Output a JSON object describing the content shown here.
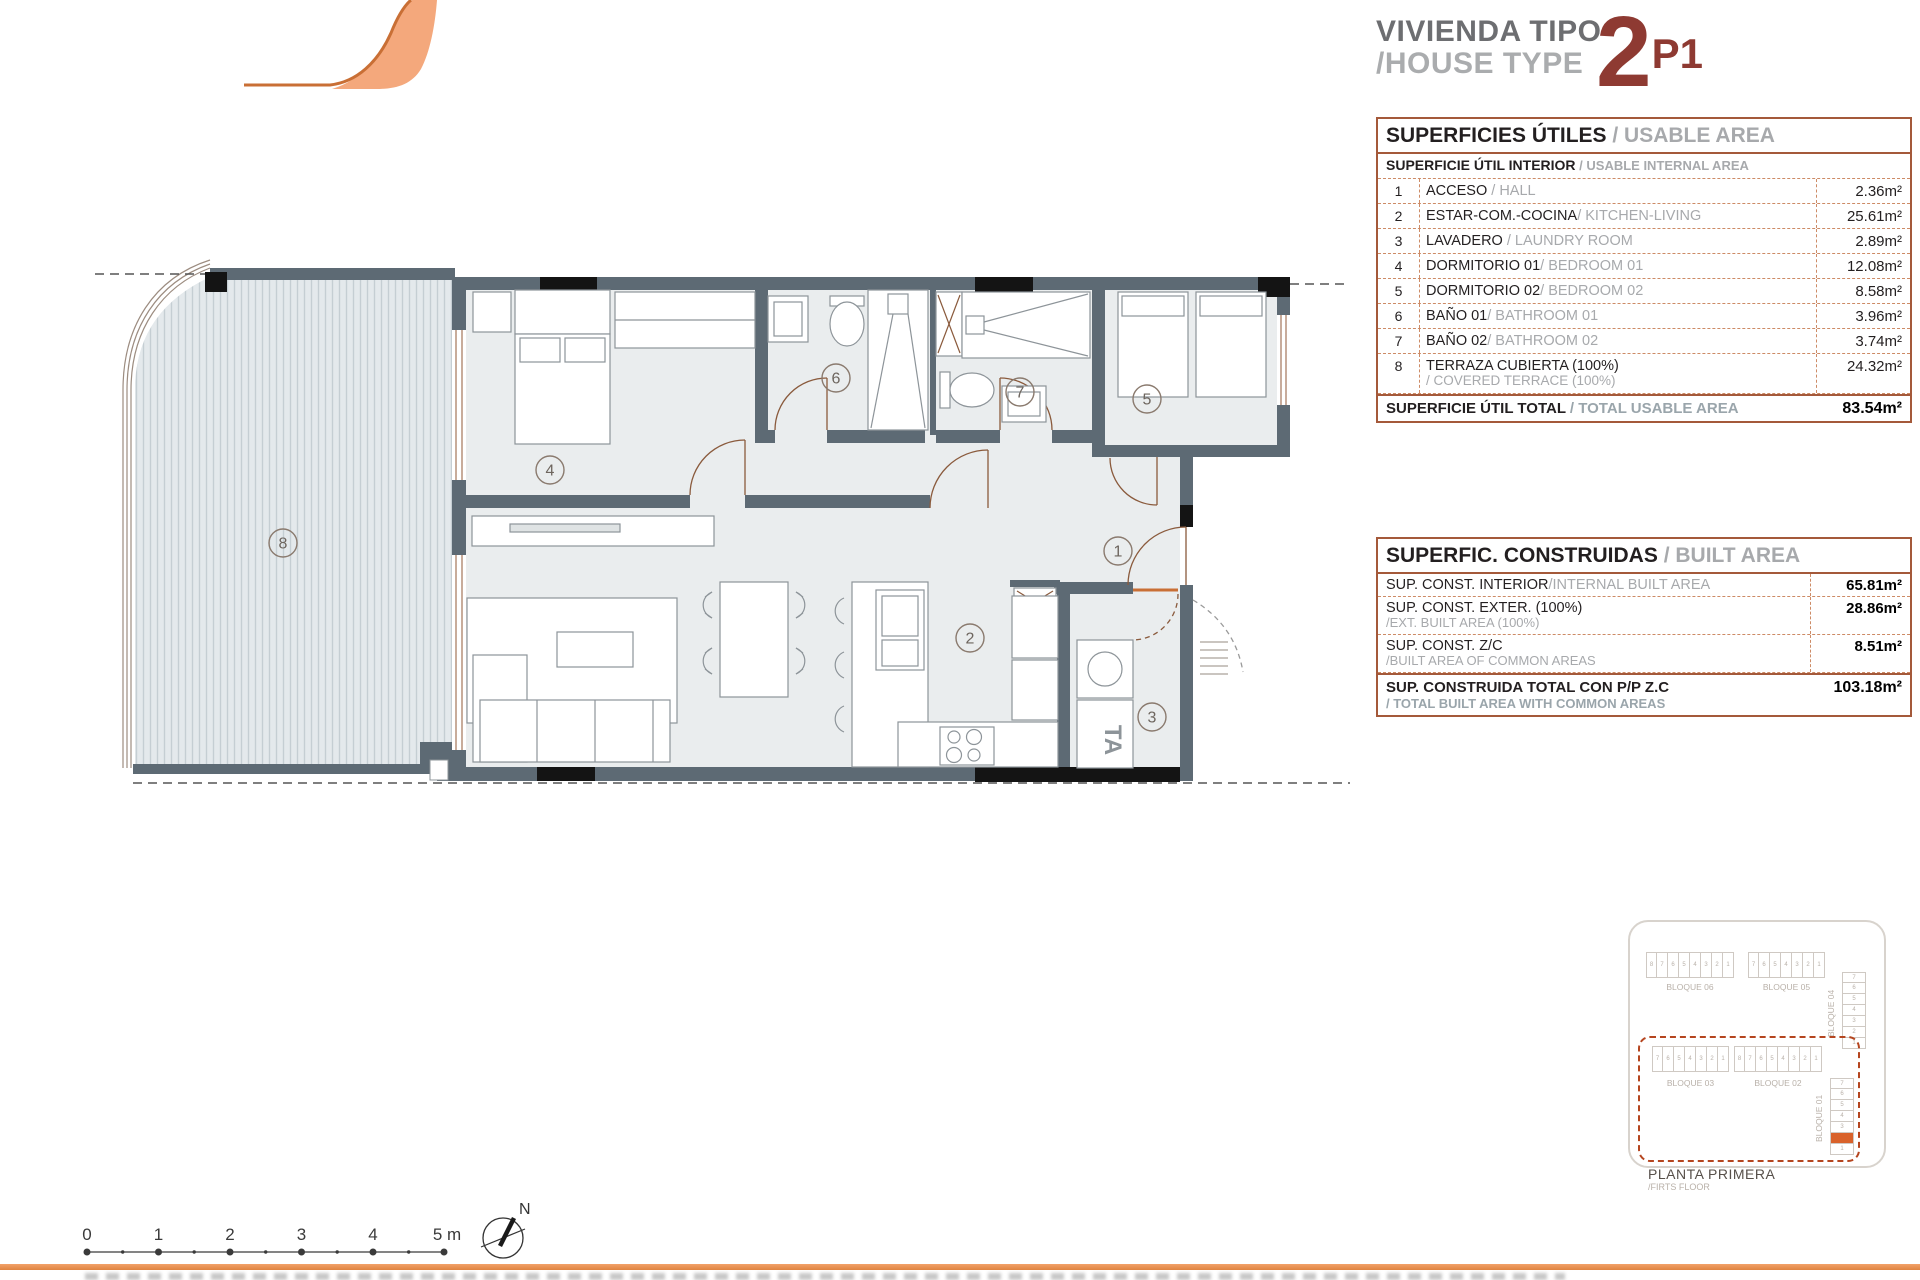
{
  "header": {
    "title_es": "VIVIENDA TIPO",
    "title_en": "/HOUSE TYPE",
    "type_number": "2",
    "type_variant": "P1"
  },
  "usable_area_table": {
    "title_es": "SUPERFICIES ÚTILES",
    "title_en": " / USABLE AREA",
    "subtitle_es": "SUPERFICIE ÚTIL INTERIOR",
    "subtitle_en": " / USABLE INTERNAL AREA",
    "rows": [
      {
        "num": "1",
        "name_es": "ACCESO",
        "name_en": " / HALL",
        "value": "2.36m²"
      },
      {
        "num": "2",
        "name_es": "ESTAR-COM.-COCINA",
        "name_en": "/ KITCHEN-LIVING",
        "value": "25.61m²"
      },
      {
        "num": "3",
        "name_es": "LAVADERO",
        "name_en": " / LAUNDRY ROOM",
        "value": "2.89m²"
      },
      {
        "num": "4",
        "name_es": "DORMITORIO 01",
        "name_en": "/ BEDROOM 01",
        "value": "12.08m²"
      },
      {
        "num": "5",
        "name_es": "DORMITORIO 02",
        "name_en": "/ BEDROOM 02",
        "value": "8.58m²"
      },
      {
        "num": "6",
        "name_es": "BAÑO 01",
        "name_en": "/ BATHROOM 01",
        "value": "3.96m²"
      },
      {
        "num": "7",
        "name_es": "BAÑO 02",
        "name_en": "/ BATHROOM 02",
        "value": "3.74m²"
      },
      {
        "num": "8",
        "name_es": "TERRAZA CUBIERTA (100%)",
        "name_en": "/ COVERED TERRACE (100%)",
        "value": "24.32m²"
      }
    ],
    "total_label_es": "SUPERFICIE ÚTIL TOTAL",
    "total_label_en": " / TOTAL USABLE AREA",
    "total_value": "83.54m²"
  },
  "built_area_table": {
    "title_es": "SUPERFIC. CONSTRUIDAS",
    "title_en": " / BUILT AREA",
    "rows": [
      {
        "label_es": "SUP. CONST. INTERIOR",
        "label_en": "/INTERNAL BUILT AREA",
        "label_en2": "",
        "value": "65.81m²"
      },
      {
        "label_es": "SUP. CONST. EXTER. (100%)",
        "label_en": "",
        "label_en2": "/EXT. BUILT AREA (100%)",
        "value": "28.86m²"
      },
      {
        "label_es": "SUP. CONST. Z/C",
        "label_en": "",
        "label_en2": "/BUILT AREA OF COMMON AREAS",
        "value": "8.51m²"
      }
    ],
    "total_label_es": "SUP. CONSTRUIDA TOTAL CON P/P Z.C",
    "total_label_en": "/ TOTAL BUILT AREA WITH COMMON AREAS",
    "total_value": "103.18m²"
  },
  "plan": {
    "numbers": [
      "1",
      "2",
      "3",
      "4",
      "5",
      "6",
      "7",
      "8"
    ],
    "laundry_label": "TA",
    "north_label": "N"
  },
  "scale_bar": {
    "labels": [
      "0",
      "1",
      "2",
      "3",
      "4",
      "5 m"
    ]
  },
  "site_key": {
    "blocks": [
      {
        "label": "BLOQUE 06",
        "cells": [
          "8",
          "7",
          "6",
          "5",
          "4",
          "3",
          "2",
          "1"
        ]
      },
      {
        "label": "BLOQUE 05",
        "cells": [
          "7",
          "6",
          "5",
          "4",
          "3",
          "2",
          "1"
        ]
      },
      {
        "label": "BLOQUE 04",
        "cells": [
          "7",
          "6",
          "5",
          "4",
          "3",
          "2",
          "1"
        ]
      },
      {
        "label": "BLOQUE 03",
        "cells": [
          "7",
          "6",
          "5",
          "4",
          "3",
          "2",
          "1"
        ]
      },
      {
        "label": "BLOQUE 02",
        "cells": [
          "8",
          "7",
          "6",
          "5",
          "4",
          "3",
          "2",
          "1"
        ]
      },
      {
        "label": "BLOQUE 01",
        "cells": [
          "7",
          "6",
          "5",
          "4",
          "3",
          "2",
          "1"
        ],
        "highlight_cell": "2"
      }
    ],
    "floor_label_es": "PLANTA PRIMERA",
    "floor_label_en": "/FIRTS FLOOR",
    "highlight_color": "#d9622b"
  },
  "colors": {
    "accent_orange": "#e98e4f",
    "brand_fill": "#f4a87c",
    "brand_stroke": "#c96f35",
    "maroon": "#8e3a32",
    "table_border": "#a4593a",
    "table_dash": "#cd8b66",
    "wall_gray": "#5d6a74",
    "room_fill": "#eaedee",
    "highlight_cell": "#d9622b"
  }
}
